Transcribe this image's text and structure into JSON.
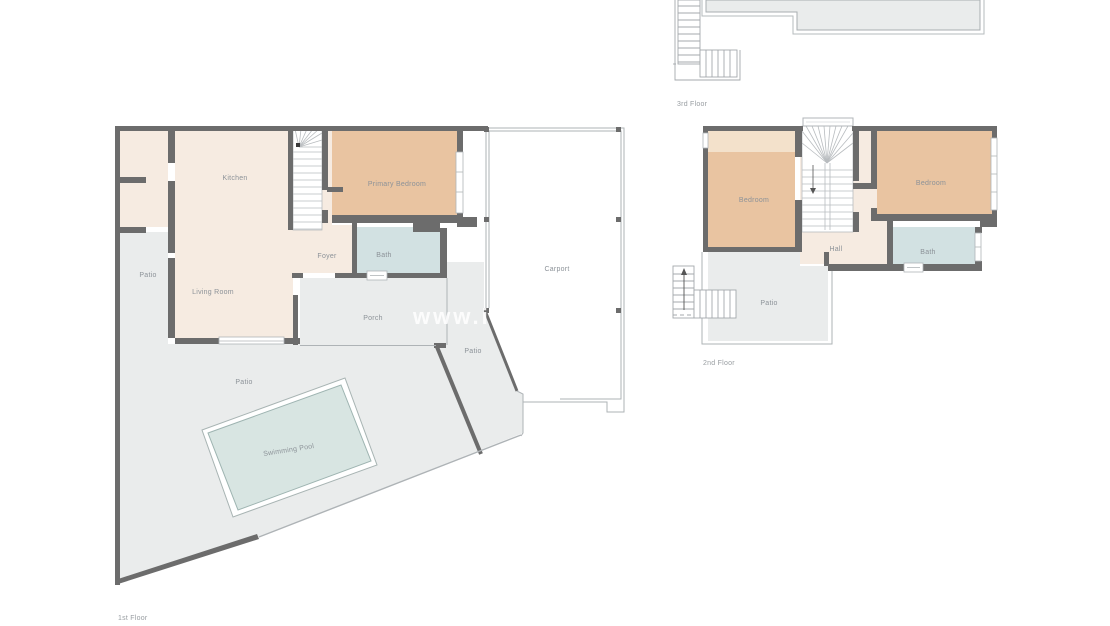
{
  "watermark": {
    "text": "www.i"
  },
  "colors": {
    "wall": "#6c6c6c",
    "interior_cream": "#f6ebe1",
    "bedroom_tan": "#e9c4a1",
    "bedroom_tan_light": "#f3e1cb",
    "bath_blue": "#d2e1e2",
    "patio_gray": "#eaecec",
    "pool_water": "#d8e5e2",
    "thin_line": "#aeb3b6",
    "label_text": "#8c9298"
  },
  "floor1": {
    "caption": "1st Floor",
    "rooms": [
      {
        "name": "kitchen",
        "label": "Kitchen"
      },
      {
        "name": "living-room",
        "label": "Living Room"
      },
      {
        "name": "foyer",
        "label": "Foyer"
      },
      {
        "name": "bath",
        "label": "Bath"
      },
      {
        "name": "primary-bedroom",
        "label": "Primary Bedroom"
      },
      {
        "name": "porch",
        "label": "Porch"
      },
      {
        "name": "carport",
        "label": "Carport"
      },
      {
        "name": "patio-left",
        "label": "Patio"
      },
      {
        "name": "patio-main",
        "label": "Patio"
      },
      {
        "name": "patio-side",
        "label": "Patio"
      },
      {
        "name": "swimming-pool",
        "label": "Swimming Pool"
      }
    ]
  },
  "floor2": {
    "caption": "2nd Floor",
    "rooms": [
      {
        "name": "bedroom-left",
        "label": "Bedroom"
      },
      {
        "name": "bedroom-right",
        "label": "Bedroom"
      },
      {
        "name": "hall",
        "label": "Hall"
      },
      {
        "name": "bath",
        "label": "Bath"
      },
      {
        "name": "patio",
        "label": "Patio"
      }
    ]
  },
  "floor3": {
    "caption": "3rd Floor"
  }
}
